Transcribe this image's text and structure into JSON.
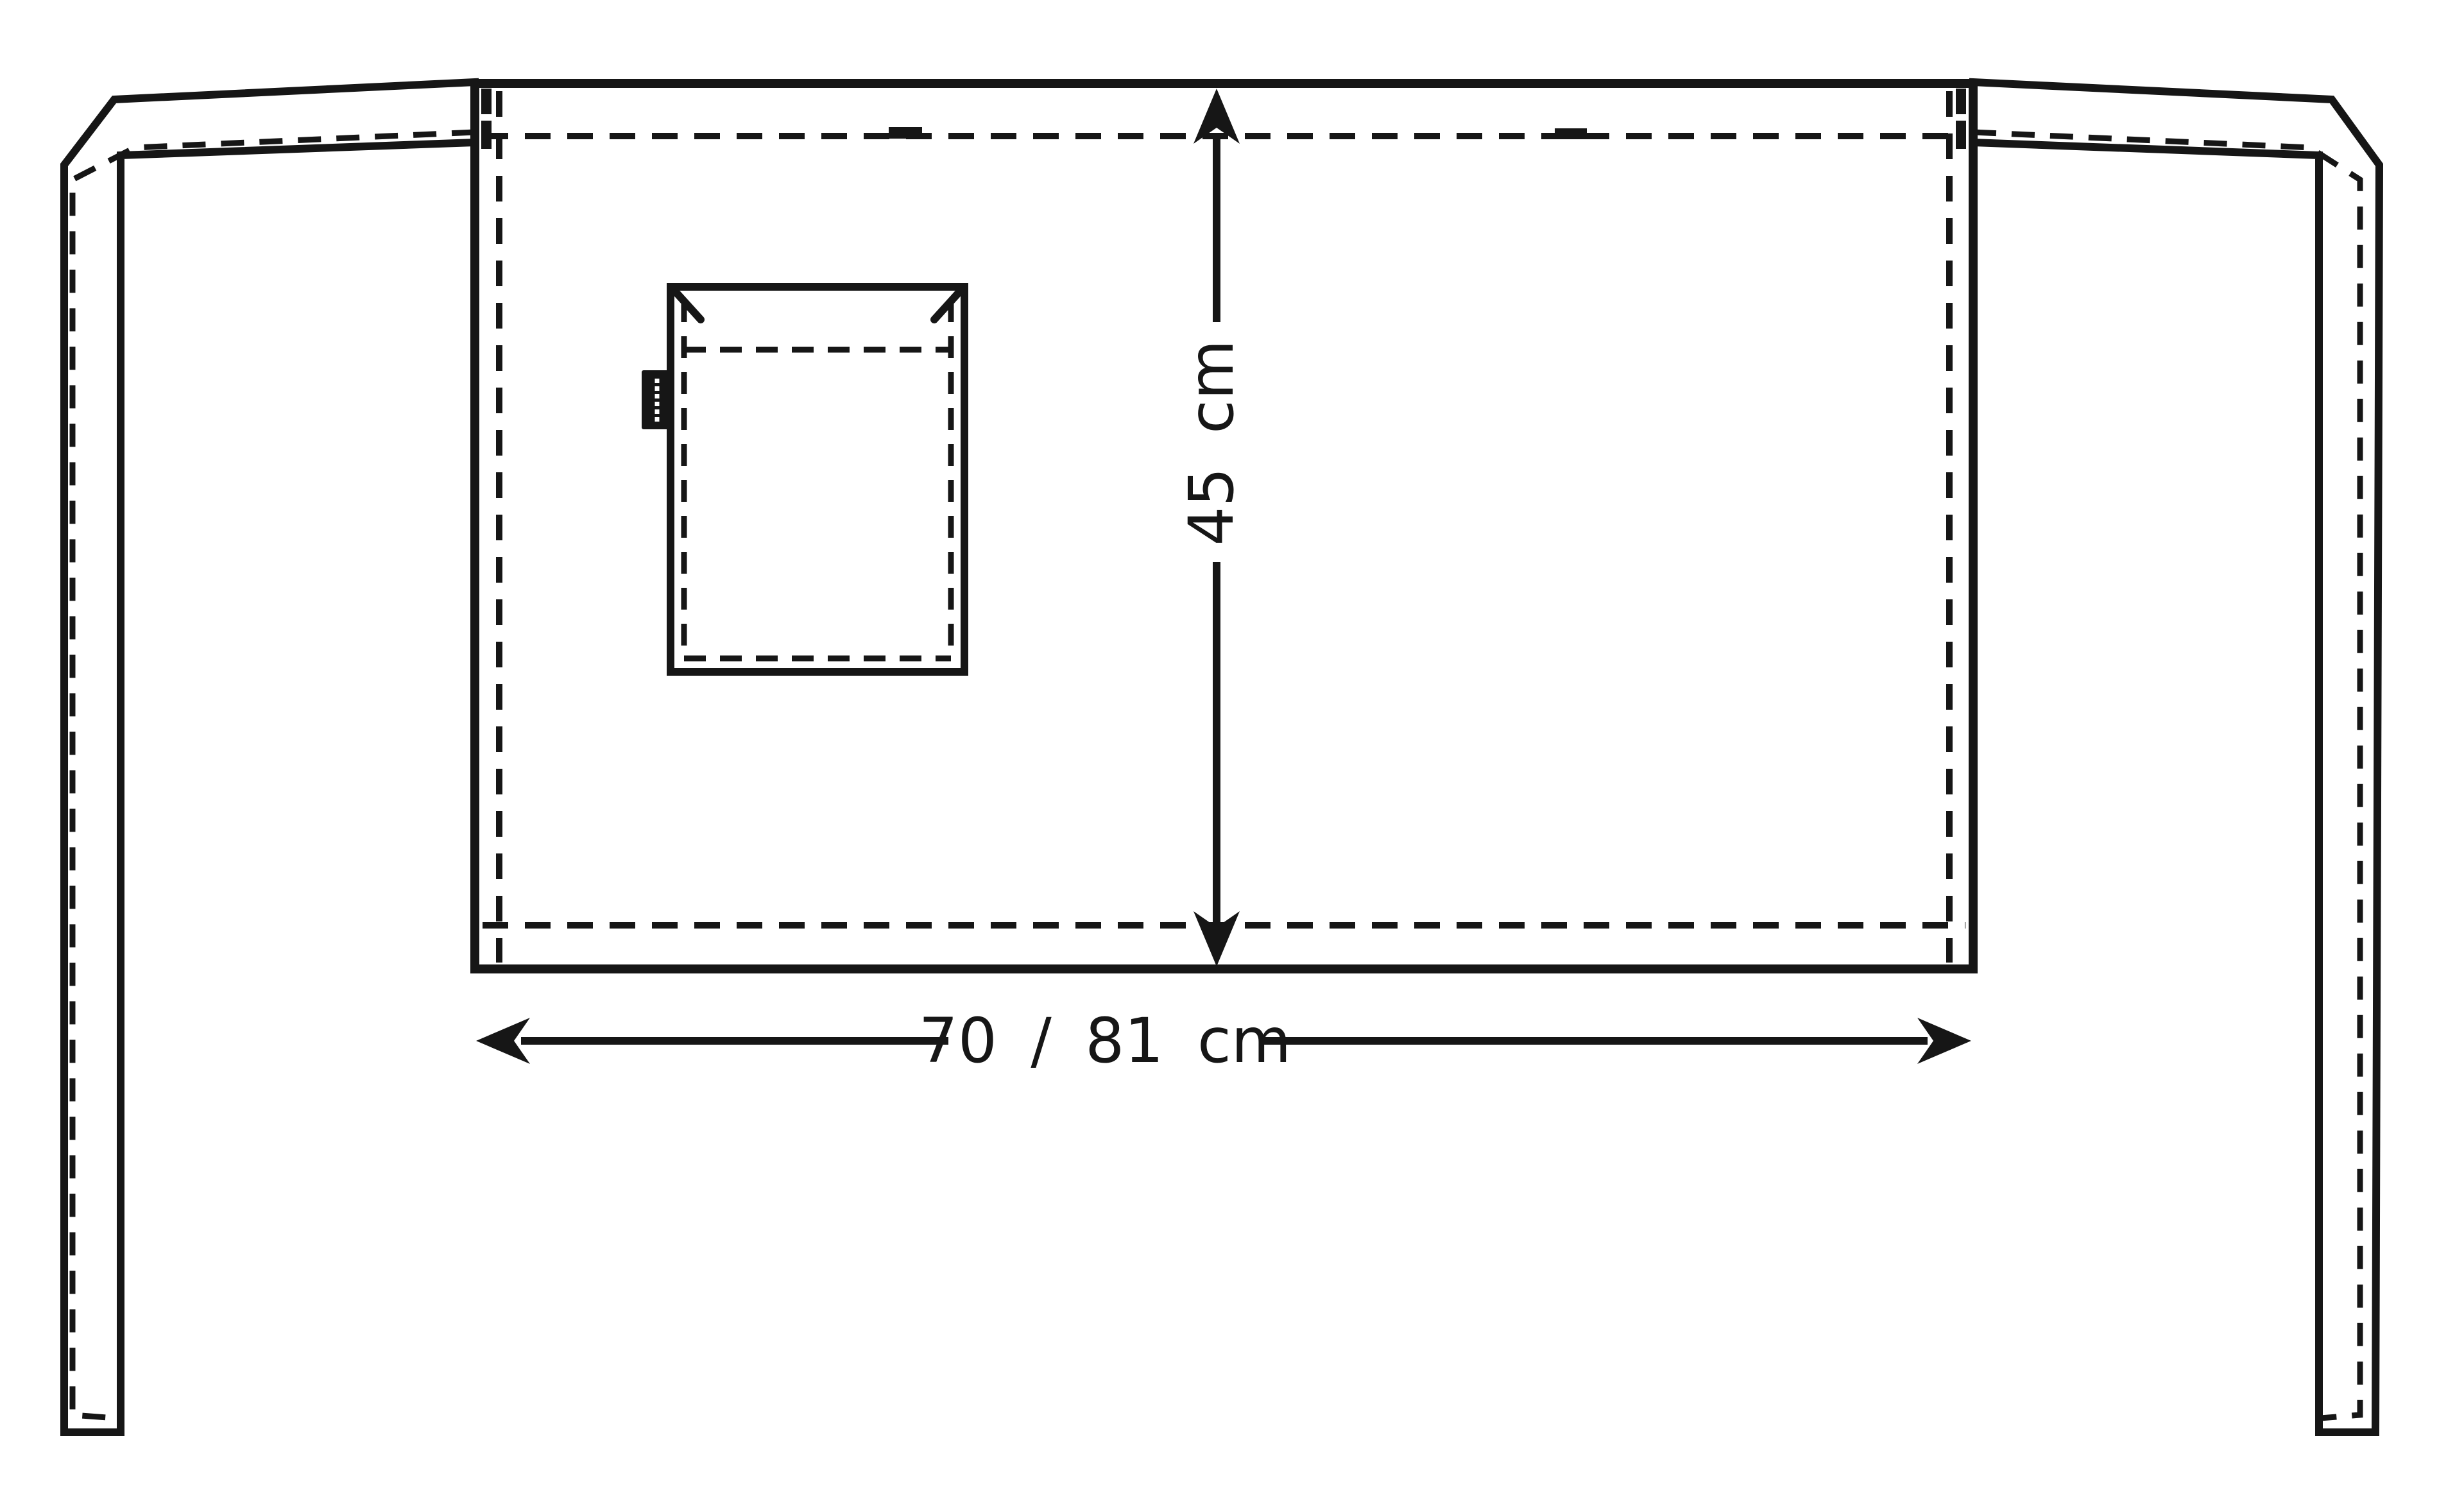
{
  "page": {
    "background_color": "#ffffff"
  },
  "diagram": {
    "type": "product-technical-drawing",
    "subject": "waist-apron-front-view",
    "line_color": "#161616",
    "labels": {
      "height": "45 cm",
      "width": "70 / 81 cm"
    },
    "values": {
      "height_cm": 45,
      "width_cm_options": [
        70,
        81
      ]
    },
    "icons": {
      "brand_label": "vertical-brand-tag"
    }
  }
}
